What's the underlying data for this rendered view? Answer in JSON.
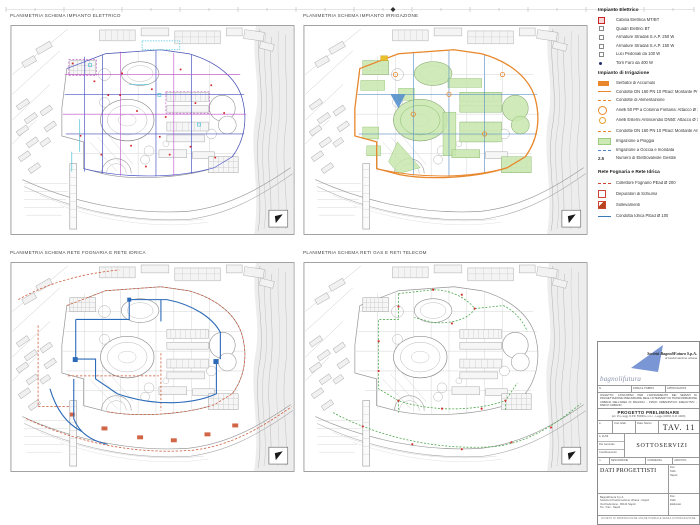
{
  "panels": [
    {
      "title": "PLANIMETRIA SCHEMA IMPIANTO ELETTRICO"
    },
    {
      "title": "PLANIMETRIA SCHEMA IMPIANTO IRRIGAZIONE"
    },
    {
      "title": "PLANIMETRIA SCHEMA RETE FOGNARIA E RETE IDRICA"
    },
    {
      "title": "PLANIMETRIA SCHEMA RETI GAS E RETI TELECOM"
    }
  ],
  "legend": {
    "electrical": {
      "title": "Impianto Elettrico",
      "items": [
        {
          "symbol": "red-square",
          "label": "Cabina Elettrica MT/BT"
        },
        {
          "symbol": "small-square",
          "label": "Quadri Elettrici BT"
        },
        {
          "symbol": "small-square",
          "label": "Armature Stradali S.A.P. 250 W"
        },
        {
          "symbol": "small-square",
          "label": "Armature Stradali S.A.P. 150 W"
        },
        {
          "symbol": "small-square",
          "label": "Luci Pedonali da 100 W"
        },
        {
          "symbol": "dark-dot",
          "label": "Torri Faro da 400 W"
        }
      ]
    },
    "irrigation": {
      "title": "Impianto di Irrigazione",
      "items": [
        {
          "symbol": "orange-rect",
          "label": "Serbatoi di Accumulo"
        },
        {
          "symbol": "orange-line",
          "label": "Condotte DN 160 PN 10 PEad: Montante Principale"
        },
        {
          "symbol": "orange-dashed",
          "label": "Condotte di Alimentazione"
        },
        {
          "symbol": "orange-circle-lg",
          "label": "Anelli 50 PP a Colonna Fontana: Attacco Ø 10 Bar"
        },
        {
          "symbol": "orange-circle-sm",
          "label": "Anelli Esterni Antincendio DN50: Attacco Ø 70"
        },
        {
          "symbol": "orange-dashdot",
          "label": "Condotte DN 160 PN 10 PEad: Montante Antincendio"
        },
        {
          "symbol": "green-rect",
          "label": "Irrigazione a Pioggia"
        },
        {
          "symbol": "blue-dashed",
          "label": "Irrigazione a Goccia e Inondata"
        },
        {
          "symbol": "text",
          "symbol_text": "2.5",
          "label": "Numero di Elettrovalvole Gestite"
        }
      ]
    },
    "sewer_water": {
      "title": "Rete Fognaria e Rete Idrica",
      "items": [
        {
          "symbol": "red-dashdot",
          "label": "Collettore Fognario PEad Ø 200"
        },
        {
          "symbol": "square-outline",
          "label": "Depuratori di Schiuma"
        },
        {
          "symbol": "square-diag",
          "label": "Sollevamenti"
        },
        {
          "symbol": "blue-line",
          "label": "Condotta Idrica PEad Ø 100"
        }
      ]
    }
  },
  "title_block": {
    "company_line1": "Società BagnoliFutura S.p.A.",
    "company_line2": "di trasformazione urbana",
    "wordmark": "bagnolifutura",
    "header_cells": [
      "N.",
      "FIRMA E TIMBRO",
      "APPROVAZIONI"
    ],
    "description": "Oggetto: concorso per l'affidamento dei servizi di progettazione preliminare degli interventi di trasformazione urbana dell'area di Bagnoli - piano urbanistico esecutivo - parco urbano",
    "phase_title": "PROGETTO PRELIMINARE",
    "phase_subtitle": "(art. 15 e segg. D.P.R. 554/99 e s.m.i. - Legge 109/94, D.M. 04/06)",
    "tav_cell1": "a",
    "tav_cell2": "Cod. Elab.",
    "tav_cell3": "Data: Marzo",
    "tav_label": "TAV. 11",
    "left_stack": [
      "a. 11/06",
      "File Generale",
      "Coordinamento"
    ],
    "drawing_title": "SOTTOSERVIZI",
    "row_headers": [
      "n.",
      "DESCRIZIONE",
      "COMMESSA",
      "ARCHIVIO"
    ],
    "designers_label": "DATI PROGETTISTI",
    "right_info_top": [
      "Doc.",
      "Tabb.",
      "Napoli"
    ],
    "address_lines": [
      "BagnoliFutura S.p.A.",
      "Società di Trasformazione Urbana - Napoli",
      "Via Diocleziano - 80124 Napoli",
      "Tel. / Fax - Napoli"
    ],
    "right_info_bottom": [
      "Doc.",
      "Tabb.",
      "Elaborato"
    ],
    "footer": "Divieto di riproduzione anche parziale senza autorizzazione"
  },
  "colors": {
    "electrical_blue": "#4a55c8",
    "electrical_magenta": "#c050c8",
    "electrical_cyan": "#4fc3d8",
    "irrigation_orange": "#e8872b",
    "irrigation_green": "#c8e6ae",
    "water_blue": "#2b6ab8",
    "sewer_red": "#cc5533",
    "gas_green": "#4aa84a",
    "legend_red": "#cc2222",
    "logo_blue": "#7b96d4"
  }
}
